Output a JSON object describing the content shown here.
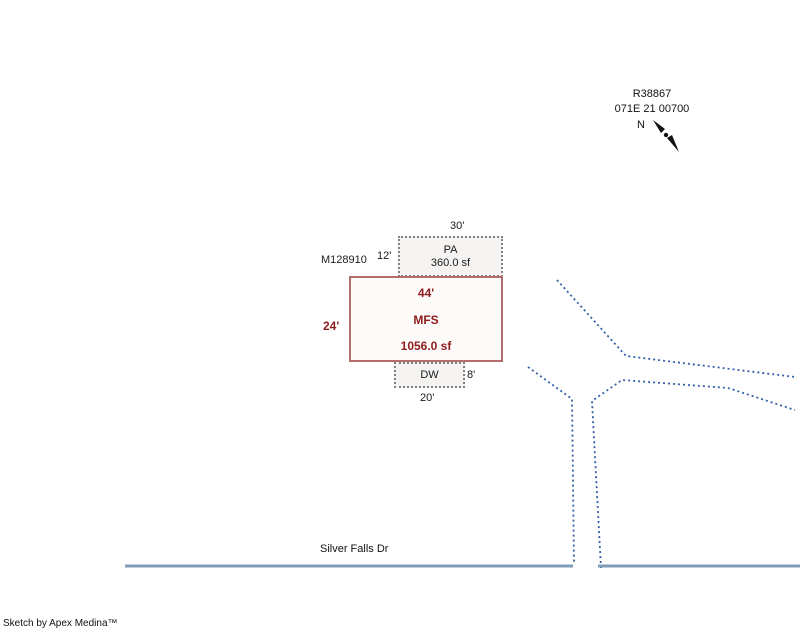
{
  "header": {
    "parcel_id": "R38867",
    "parcel_number": "071E 21 00700",
    "north_label": "N"
  },
  "sketch": {
    "mfs": {
      "label": "MFS",
      "area": "1056.0 sf",
      "top_dim": "44'",
      "left_dim": "24'"
    },
    "pa": {
      "label": "PA",
      "area": "360.0 sf",
      "top_dim": "30'",
      "left_dim": "12'"
    },
    "pa_ref": "M128910",
    "dw": {
      "label": "DW",
      "bottom_dim": "20'",
      "right_dim": "8'"
    }
  },
  "road": {
    "name": "Silver Falls Dr",
    "segments": [
      [
        [
          125,
          566
        ],
        [
          573,
          566
        ]
      ],
      [
        [
          598,
          566
        ],
        [
          800,
          566
        ]
      ]
    ]
  },
  "boundaries": {
    "lines": [
      [
        [
          557,
          280
        ],
        [
          626,
          356
        ],
        [
          795,
          377
        ]
      ],
      [
        [
          528,
          367
        ],
        [
          572,
          399
        ],
        [
          574,
          563
        ]
      ],
      [
        [
          601,
          568
        ],
        [
          592,
          401
        ],
        [
          622,
          380
        ],
        [
          728,
          388
        ],
        [
          795,
          410
        ]
      ]
    ]
  },
  "footer": {
    "credit": "Sketch by Apex Medina™"
  },
  "colors": {
    "boundary": "#335fa8",
    "road": "#7f9db9",
    "building_border": "#b36d6d",
    "building_text": "#8e1c1c",
    "outbuilding_border": "#828282"
  }
}
